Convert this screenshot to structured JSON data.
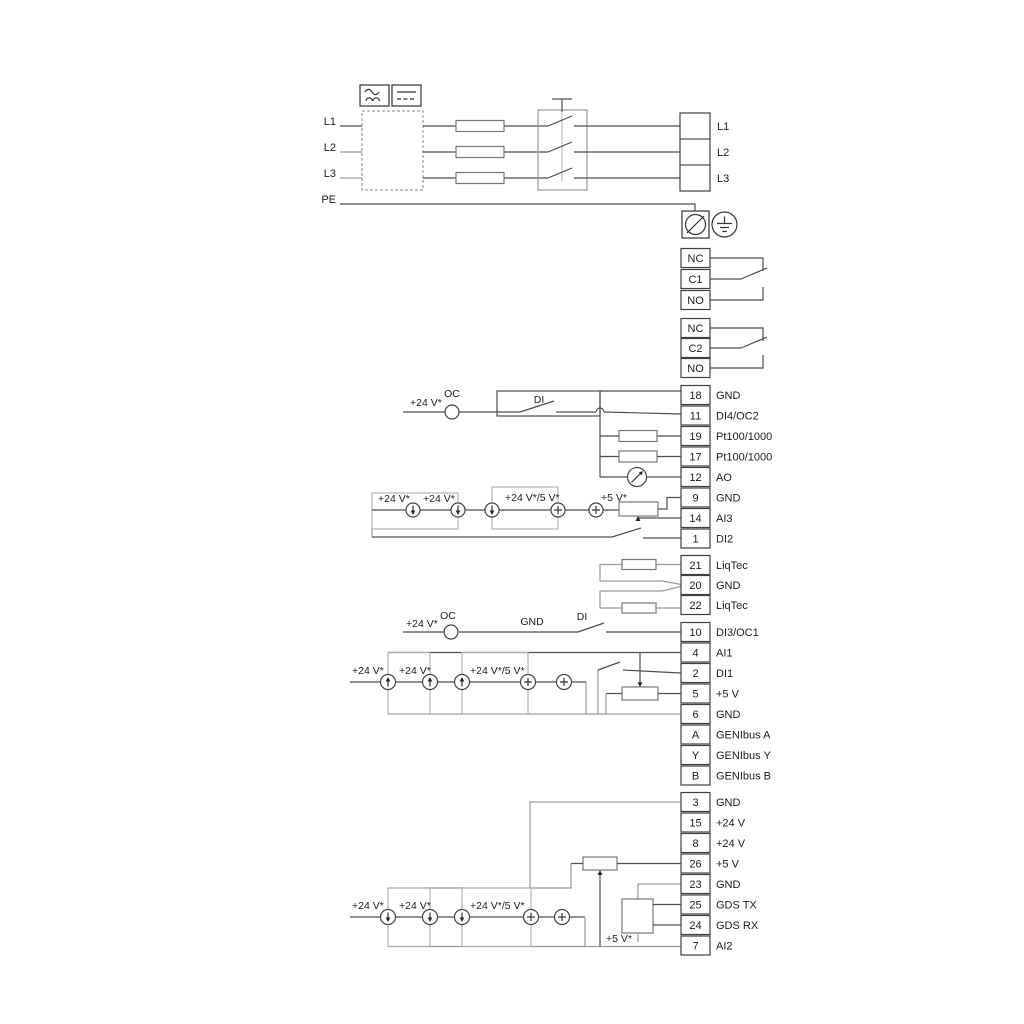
{
  "power_input": {
    "l1": "L1",
    "l2": "L2",
    "l3": "L3",
    "pe": "PE"
  },
  "power_output": {
    "l1": "L1",
    "l2": "L2",
    "l3": "L3"
  },
  "relay1": {
    "nc": "NC",
    "c": "C1",
    "no": "NO"
  },
  "relay2": {
    "nc": "NC",
    "c": "C2",
    "no": "NO"
  },
  "io1": {
    "rows": [
      {
        "pin": "18",
        "label": "GND"
      },
      {
        "pin": "11",
        "label": "DI4/OC2"
      },
      {
        "pin": "19",
        "label": "Pt100/1000"
      },
      {
        "pin": "17",
        "label": "Pt100/1000"
      },
      {
        "pin": "12",
        "label": "AO"
      },
      {
        "pin": "9",
        "label": "GND"
      },
      {
        "pin": "14",
        "label": "AI3"
      },
      {
        "pin": "1",
        "label": "DI2"
      }
    ]
  },
  "liqtec": {
    "rows": [
      {
        "pin": "21",
        "label": "LiqTec"
      },
      {
        "pin": "20",
        "label": "GND"
      },
      {
        "pin": "22",
        "label": "LiqTec"
      }
    ]
  },
  "io2": {
    "rows": [
      {
        "pin": "10",
        "label": "DI3/OC1"
      },
      {
        "pin": "4",
        "label": "AI1"
      },
      {
        "pin": "2",
        "label": "DI1"
      },
      {
        "pin": "5",
        "label": "+5 V"
      },
      {
        "pin": "6",
        "label": "GND"
      },
      {
        "pin": "A",
        "label": "GENIbus A"
      },
      {
        "pin": "Y",
        "label": "GENIbus Y"
      },
      {
        "pin": "B",
        "label": "GENIbus B"
      }
    ]
  },
  "io3": {
    "rows": [
      {
        "pin": "3",
        "label": "GND"
      },
      {
        "pin": "15",
        "label": "+24 V"
      },
      {
        "pin": "8",
        "label": "+24 V"
      },
      {
        "pin": "26",
        "label": "+5 V"
      },
      {
        "pin": "23",
        "label": "GND"
      },
      {
        "pin": "25",
        "label": "GDS TX"
      },
      {
        "pin": "24",
        "label": "GDS RX"
      },
      {
        "pin": "7",
        "label": "AI2"
      }
    ]
  },
  "annotations": {
    "v24": "+24 V*",
    "v24_5": "+24 V*/5 V*",
    "v5": "+5 V*",
    "oc": "OC",
    "di": "DI",
    "gnd": "GND"
  },
  "colors": {
    "wire": "#4e4e4e",
    "group_box": "#adadad",
    "background": "#ffffff"
  }
}
